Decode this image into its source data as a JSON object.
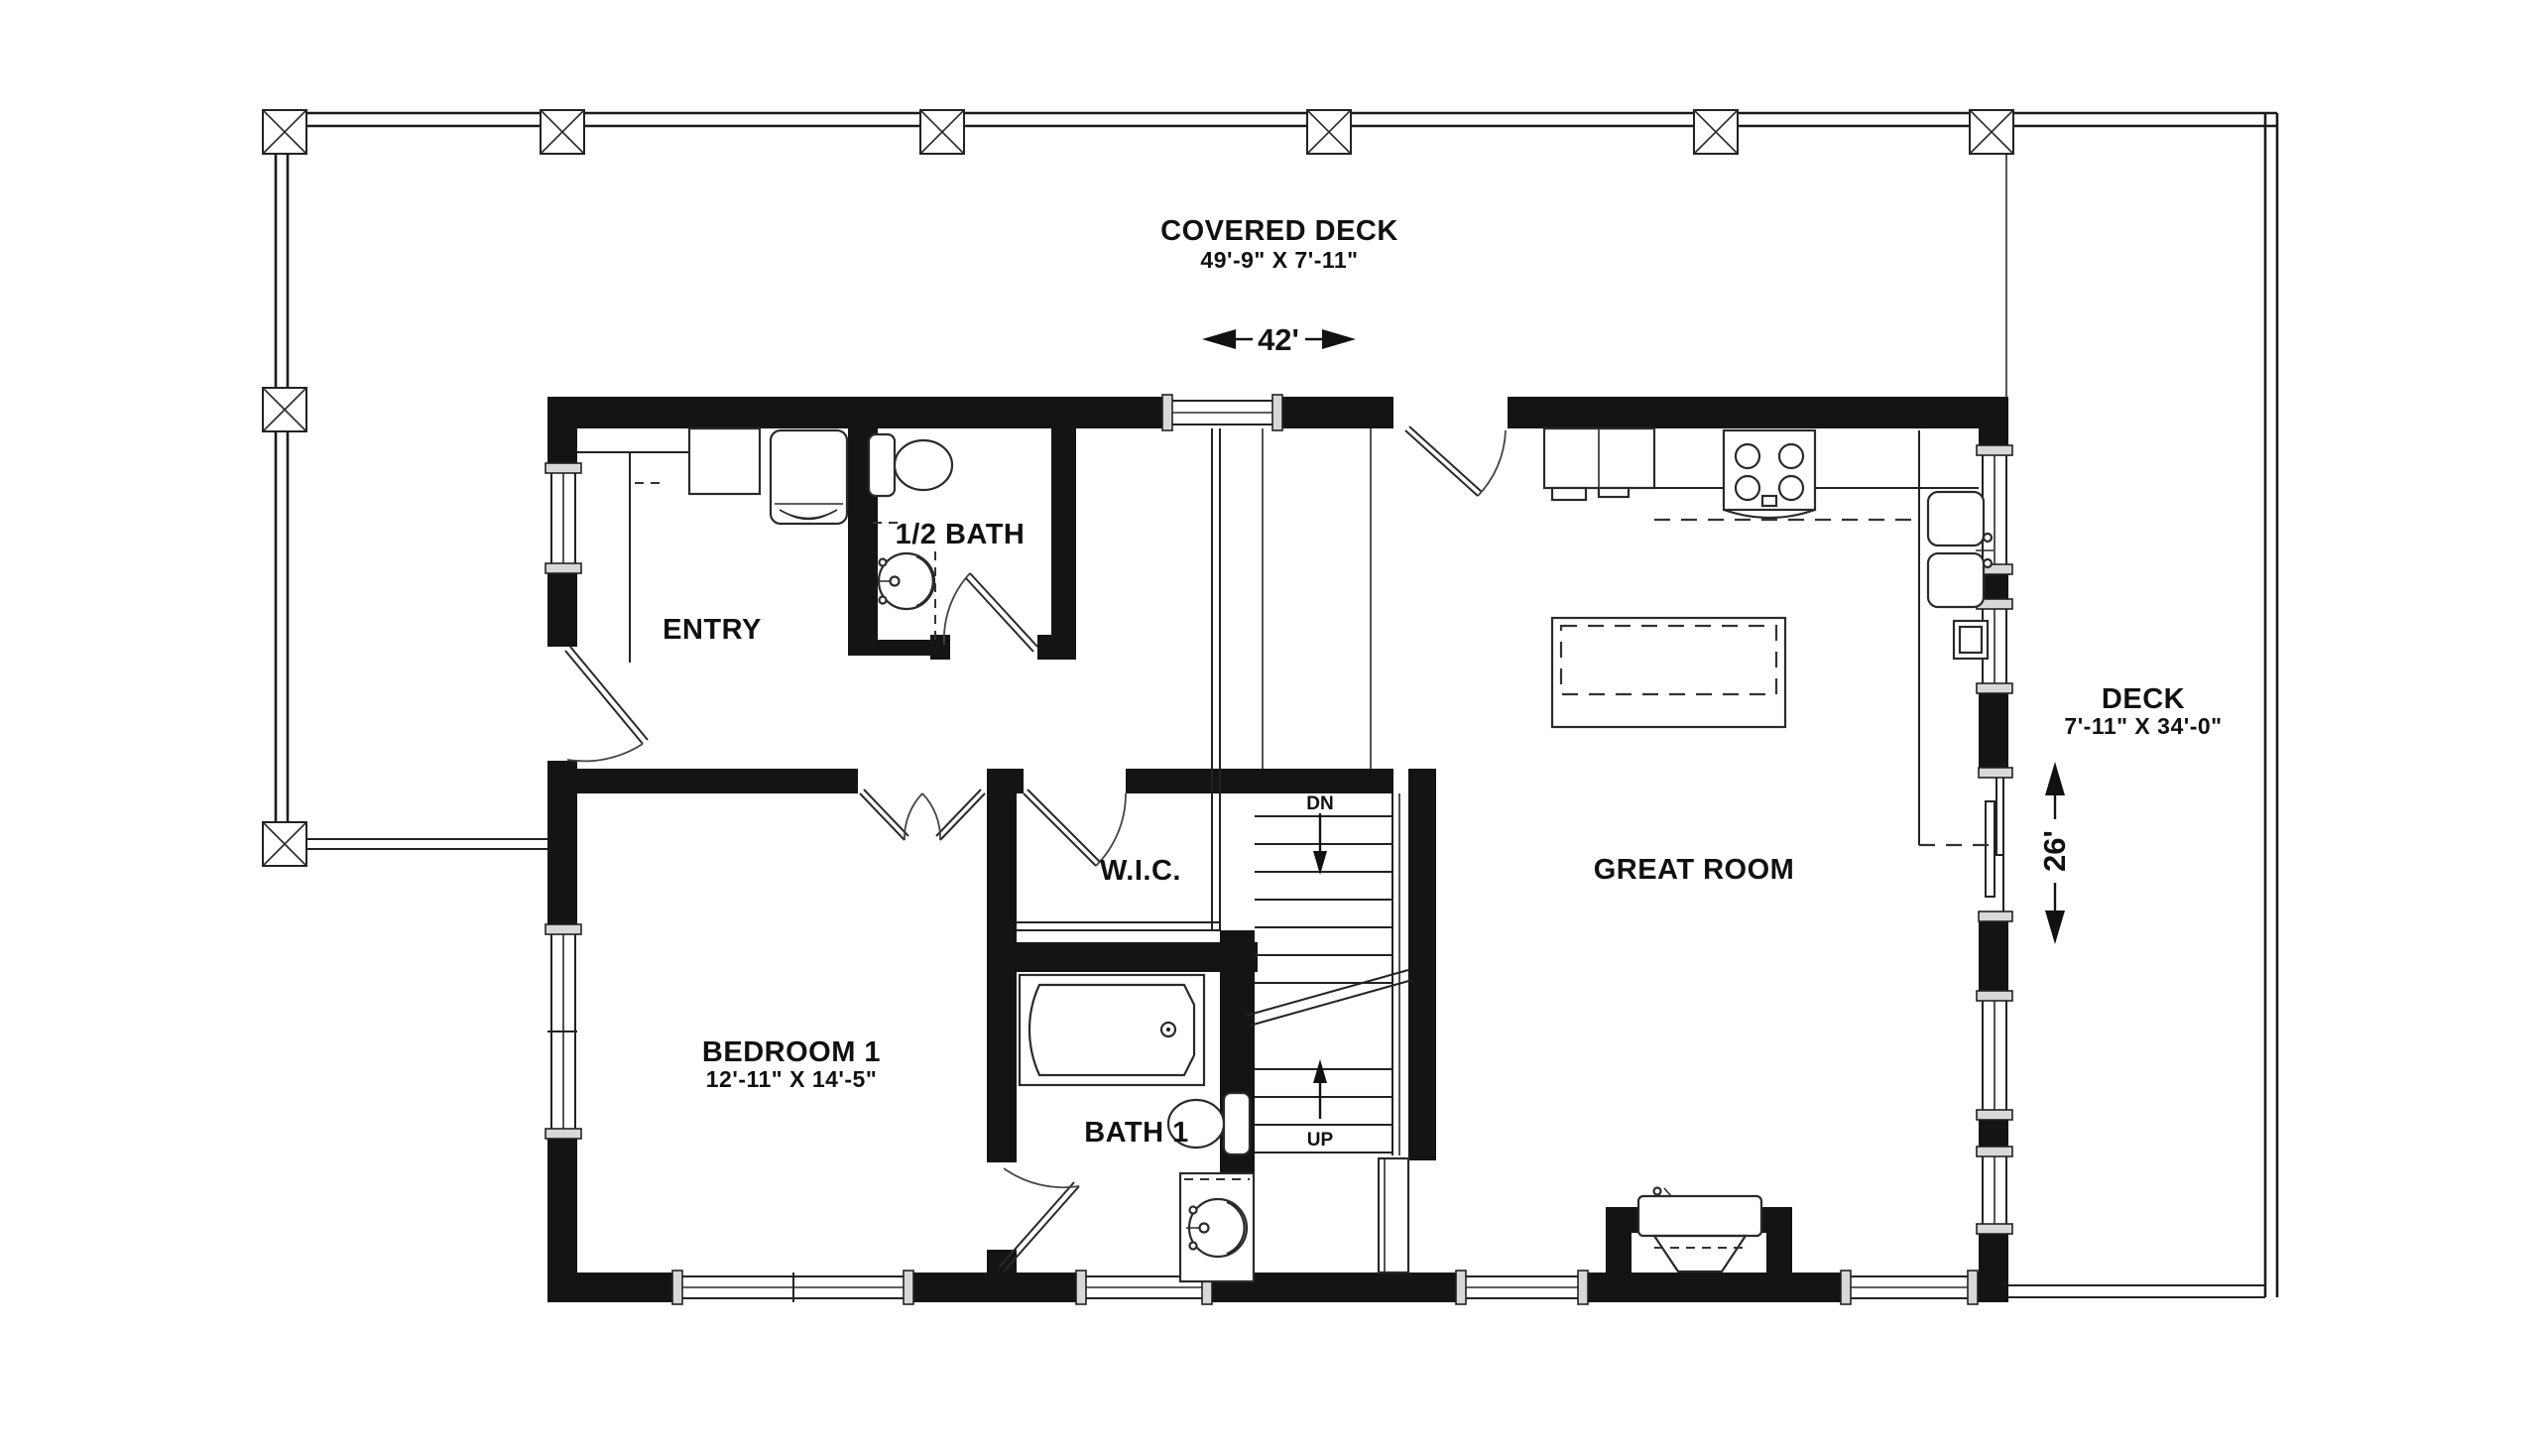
{
  "rooms": {
    "covered_deck": {
      "name": "COVERED DECK",
      "dims": "49'-9\" X 7'-11\""
    },
    "deck": {
      "name": "DECK",
      "dims": "7'-11\" X 34'-0\""
    },
    "great_room": {
      "name": "GREAT ROOM"
    },
    "entry": {
      "name": "ENTRY"
    },
    "half_bath": {
      "name": "1/2 BATH"
    },
    "wic": {
      "name": "W.I.C."
    },
    "bedroom_1": {
      "name": "BEDROOM 1",
      "dims": "12'-11\" X 14'-5\""
    },
    "bath_1": {
      "name": "BATH 1"
    }
  },
  "dimensions": {
    "overall_width": "42'",
    "overall_depth": "26'"
  },
  "stairs": {
    "down": "DN",
    "up": "UP"
  },
  "colors": {
    "walls": "#141414",
    "lines": "#222222",
    "background": "#ffffff",
    "window_cap": "#d8d8d8"
  }
}
